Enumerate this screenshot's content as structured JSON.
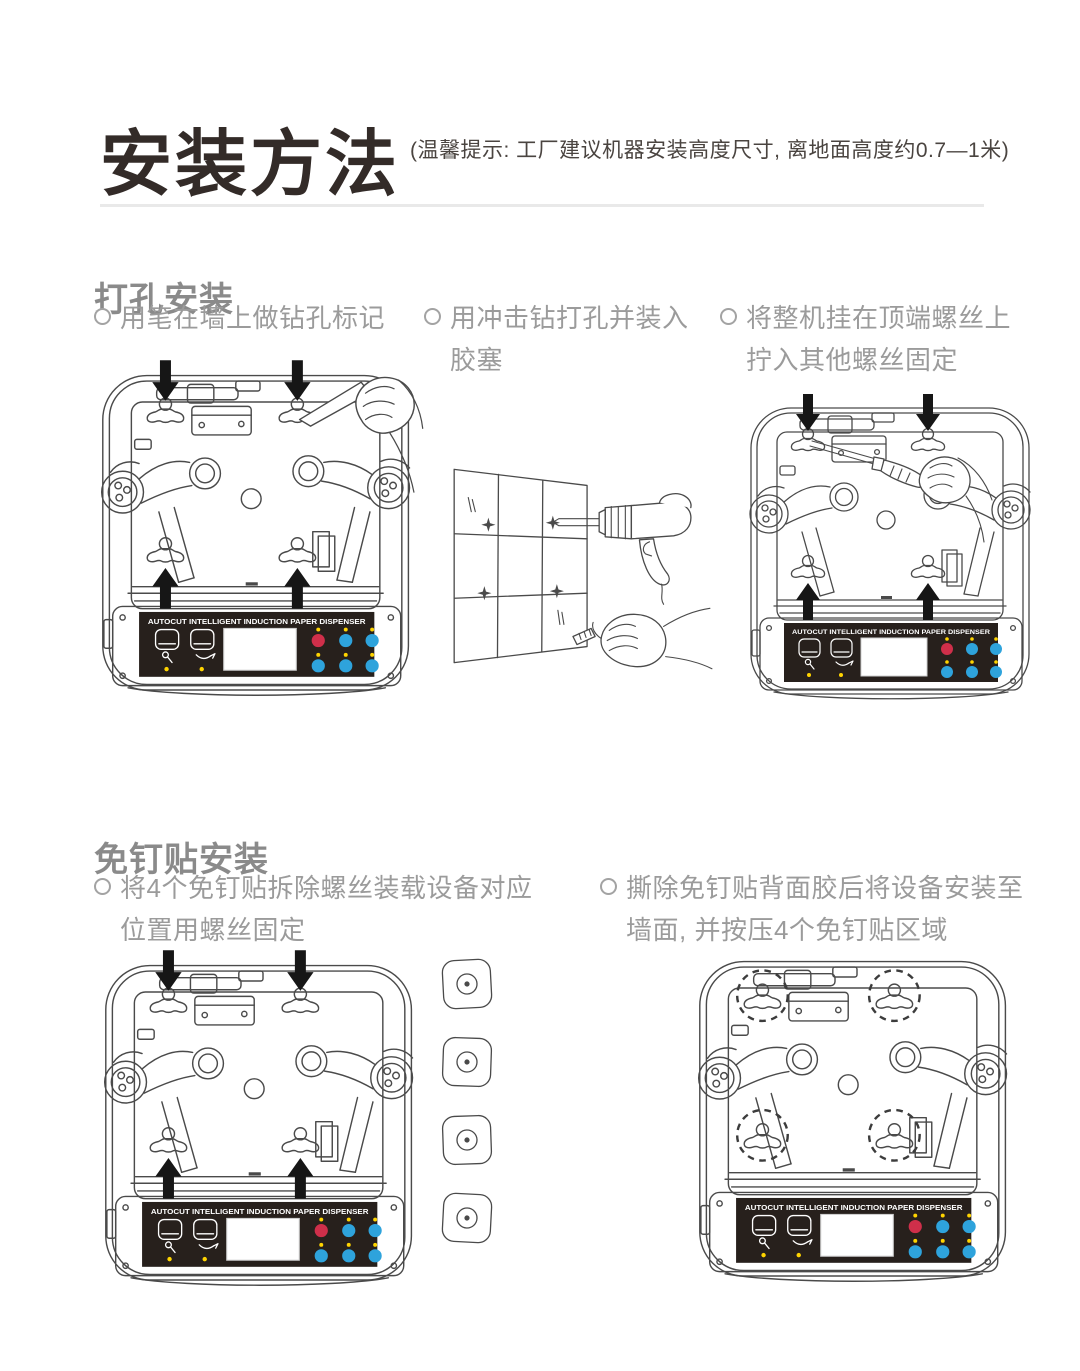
{
  "header": {
    "title": "安装方法",
    "note": "(温馨提示: 工厂建议机器安装高度尺寸, 离地面高度约0.7—1米)"
  },
  "sections": [
    {
      "heading": "打孔安装",
      "steps": [
        {
          "text": "用笔在墙上做钻孔标记"
        },
        {
          "text": "用冲击钻打孔并装入\n胶塞"
        },
        {
          "text": "将整机挂在顶端螺丝上\n拧入其他螺丝固定"
        }
      ]
    },
    {
      "heading": "免钉贴安装",
      "steps": [
        {
          "text": "将4个免钉贴拆除螺丝装载设备对应\n位置用螺丝固定"
        },
        {
          "text": "撕除免钉贴背面胶后将设备安装至\n墙面, 并按压4个免钉贴区域"
        }
      ]
    }
  ],
  "device_panel_label": "AUTOCUT  INTELLIGENT  INDUCTION  PAPER  DISPENSER",
  "colors": {
    "line": "#4a4a4a",
    "arrow": "#161616",
    "panel_black": "#27201c",
    "button_red": "#cf2f4a",
    "button_blue": "#2ea3dc",
    "led_yellow": "#ffd400",
    "divider_gray": "#e9e9e9",
    "heading_gray": "#8a8a8a",
    "body_gray": "#9b9b9b",
    "title_dark": "#332b28"
  }
}
